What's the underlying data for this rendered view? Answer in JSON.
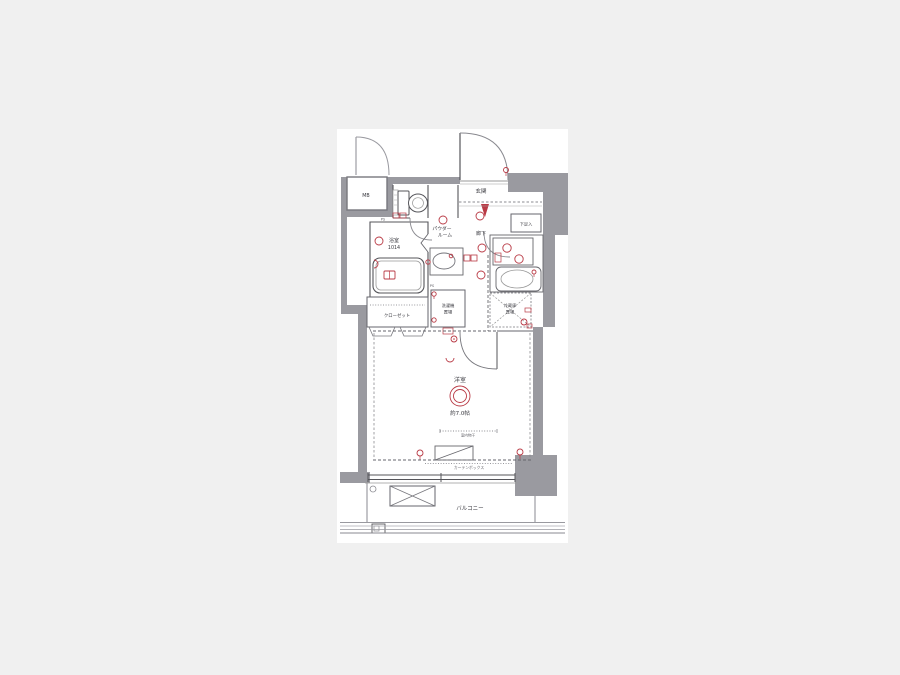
{
  "canvas": {
    "width": 900,
    "height": 675,
    "background": "#f0f0f0",
    "paper_background": "#ffffff"
  },
  "colors": {
    "wall": "#9a9aa0",
    "line": "#55555a",
    "thin_line": "#888888",
    "accent_red": "#b93a45",
    "text": "#3a3a40",
    "text_light": "#66666c"
  },
  "floorplan": {
    "labels": {
      "mb": "MB",
      "ps_upper": "PS",
      "ps_lower": "PS",
      "entrance": "玄関",
      "shoe_box": "下足入",
      "hallway": "廊下",
      "powder_room_line1": "パウダー",
      "powder_room_line2": "ルーム",
      "bathroom": "浴室",
      "bathroom_size": "1014",
      "closet": "クローゼット",
      "washer_line1": "洗濯機",
      "washer_line2": "置場",
      "fridge_line1": "冷蔵庫",
      "fridge_line2": "置場",
      "main_room": "洋室",
      "main_room_size": "約7.0帖",
      "indoor_drying": "室内物干",
      "curtain_box": "カーテンボックス",
      "balcony": "バルコニー"
    },
    "icons": {
      "ceiling_light": "double-circle",
      "wall_light": "stem-circle",
      "stove_burner": "circle",
      "faucet": "stem-circle",
      "switch": "square",
      "evacuation_hatch": "crossed-box",
      "bathtub_control": "boxed-pair"
    }
  }
}
